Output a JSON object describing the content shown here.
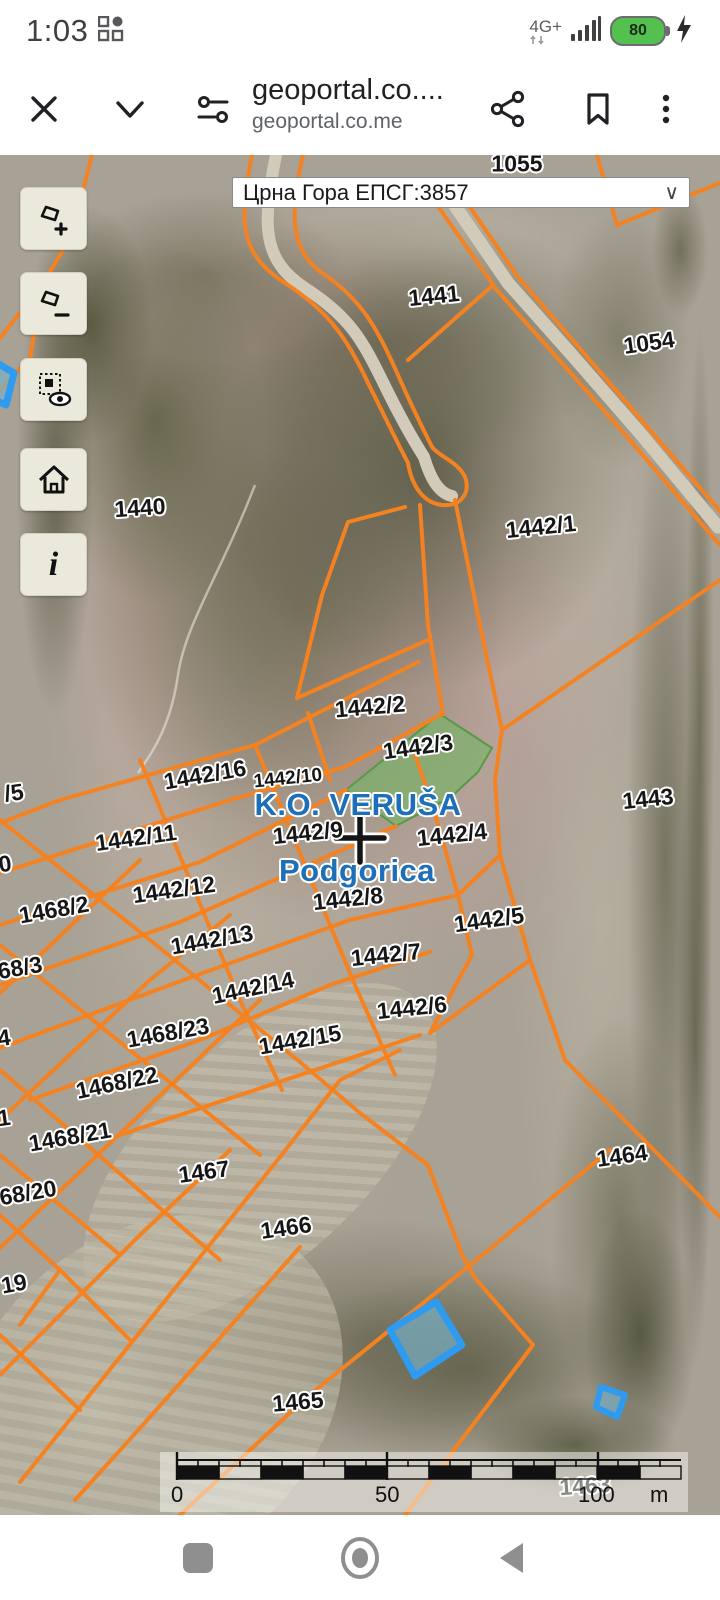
{
  "status_bar": {
    "time": "1:03",
    "network": "4G+",
    "battery": "80"
  },
  "browser_bar": {
    "title": "geoportal.co....",
    "subtitle": "geoportal.co.me",
    "icons": [
      "close",
      "collapse",
      "tune",
      "share",
      "bookmark",
      "overflow-menu"
    ]
  },
  "map": {
    "projection_selector": "Црна Гора ЕПСГ:3857",
    "controls": [
      {
        "name": "zoom-in-extent",
        "glyph": "+"
      },
      {
        "name": "zoom-out-extent",
        "glyph": "−"
      },
      {
        "name": "layer-visibility",
        "glyph": ""
      },
      {
        "name": "home-extent",
        "glyph": ""
      },
      {
        "name": "info",
        "glyph": "i"
      }
    ],
    "cadastral_municipality": "K.O. VERUŠA",
    "municipality": "Podgorica",
    "labels": [
      {
        "text": "1055",
        "x": 517,
        "y": 9,
        "kind": "parcel",
        "rot": 0
      },
      {
        "text": "1441",
        "x": 434,
        "y": 141,
        "kind": "parcel",
        "rot": -6
      },
      {
        "text": "1054",
        "x": 649,
        "y": 188,
        "kind": "parcel",
        "rot": -8
      },
      {
        "text": "1440",
        "x": 140,
        "y": 353,
        "kind": "parcel",
        "rot": -4
      },
      {
        "text": "1442/1",
        "x": 541,
        "y": 372,
        "kind": "parcel",
        "rot": -6
      },
      {
        "text": "1442/2",
        "x": 370,
        "y": 552,
        "kind": "parcel",
        "rot": -5
      },
      {
        "text": "1442/3",
        "x": 418,
        "y": 592,
        "kind": "parcel",
        "rot": -8
      },
      {
        "text": "1442/16",
        "x": 205,
        "y": 620,
        "kind": "parcel",
        "rot": -10
      },
      {
        "text": "1442/10",
        "x": 288,
        "y": 624,
        "kind": "parcel-small",
        "rot": -6
      },
      {
        "text": "/5",
        "x": 14,
        "y": 638,
        "kind": "parcel",
        "rot": -8
      },
      {
        "text": "K.O. VERUŠA",
        "x": 358,
        "y": 650,
        "kind": "area",
        "rot": 0
      },
      {
        "text": "1442/11",
        "x": 136,
        "y": 683,
        "kind": "parcel",
        "rot": -8
      },
      {
        "text": "1442/9",
        "x": 308,
        "y": 678,
        "kind": "parcel",
        "rot": -6
      },
      {
        "text": "1442/4",
        "x": 452,
        "y": 680,
        "kind": "parcel",
        "rot": -6
      },
      {
        "text": "1443",
        "x": 648,
        "y": 644,
        "kind": "parcel",
        "rot": -6
      },
      {
        "text": "Podgorica",
        "x": 357,
        "y": 716,
        "kind": "area",
        "rot": 0
      },
      {
        "text": "0",
        "x": 5,
        "y": 709,
        "kind": "parcel",
        "rot": -8
      },
      {
        "text": "1468/2",
        "x": 54,
        "y": 755,
        "kind": "parcel",
        "rot": -10
      },
      {
        "text": "1442/12",
        "x": 174,
        "y": 735,
        "kind": "parcel",
        "rot": -8
      },
      {
        "text": "1442/8",
        "x": 348,
        "y": 744,
        "kind": "parcel",
        "rot": -6
      },
      {
        "text": "68/3",
        "x": 20,
        "y": 813,
        "kind": "parcel",
        "rot": -10
      },
      {
        "text": "1442/13",
        "x": 212,
        "y": 785,
        "kind": "parcel",
        "rot": -10
      },
      {
        "text": "1442/5",
        "x": 489,
        "y": 765,
        "kind": "parcel",
        "rot": -8
      },
      {
        "text": "1442/14",
        "x": 253,
        "y": 833,
        "kind": "parcel",
        "rot": -12
      },
      {
        "text": "1442/7",
        "x": 386,
        "y": 800,
        "kind": "parcel",
        "rot": -6
      },
      {
        "text": "1442/6",
        "x": 412,
        "y": 853,
        "kind": "parcel",
        "rot": -6
      },
      {
        "text": "1468/23",
        "x": 168,
        "y": 878,
        "kind": "parcel",
        "rot": -10
      },
      {
        "text": "1442/15",
        "x": 300,
        "y": 885,
        "kind": "parcel",
        "rot": -10
      },
      {
        "text": "1468/22",
        "x": 117,
        "y": 928,
        "kind": "parcel",
        "rot": -12
      },
      {
        "text": "4",
        "x": 4,
        "y": 883,
        "kind": "parcel",
        "rot": -8
      },
      {
        "text": "1",
        "x": 4,
        "y": 963,
        "kind": "parcel",
        "rot": -8
      },
      {
        "text": "1468/21",
        "x": 70,
        "y": 982,
        "kind": "parcel",
        "rot": -10
      },
      {
        "text": "68/20",
        "x": 28,
        "y": 1038,
        "kind": "parcel",
        "rot": -10
      },
      {
        "text": "1467",
        "x": 204,
        "y": 1017,
        "kind": "parcel",
        "rot": -8
      },
      {
        "text": "1464",
        "x": 622,
        "y": 1001,
        "kind": "parcel",
        "rot": -8
      },
      {
        "text": "1466",
        "x": 286,
        "y": 1073,
        "kind": "parcel",
        "rot": -8
      },
      {
        "text": "19",
        "x": 14,
        "y": 1129,
        "kind": "parcel",
        "rot": -10
      },
      {
        "text": "1465",
        "x": 298,
        "y": 1247,
        "kind": "parcel",
        "rot": -5
      },
      {
        "text": "1463",
        "x": 585,
        "y": 1331,
        "kind": "parcel",
        "rot": -4
      }
    ],
    "scale_bar": {
      "tick_0": "0",
      "tick_50": "50",
      "tick_100": "100",
      "unit": "m"
    },
    "colors": {
      "parcel_line": "#f58220",
      "road_fill": "#d2cbba",
      "selected_parcel_fill": "#74b464",
      "building_outline": "#2e9bf0",
      "area_label": "#1c6fb8",
      "control_bg": "#eae9db"
    }
  },
  "nav_bar": {
    "buttons": [
      "recents",
      "home",
      "back"
    ]
  }
}
